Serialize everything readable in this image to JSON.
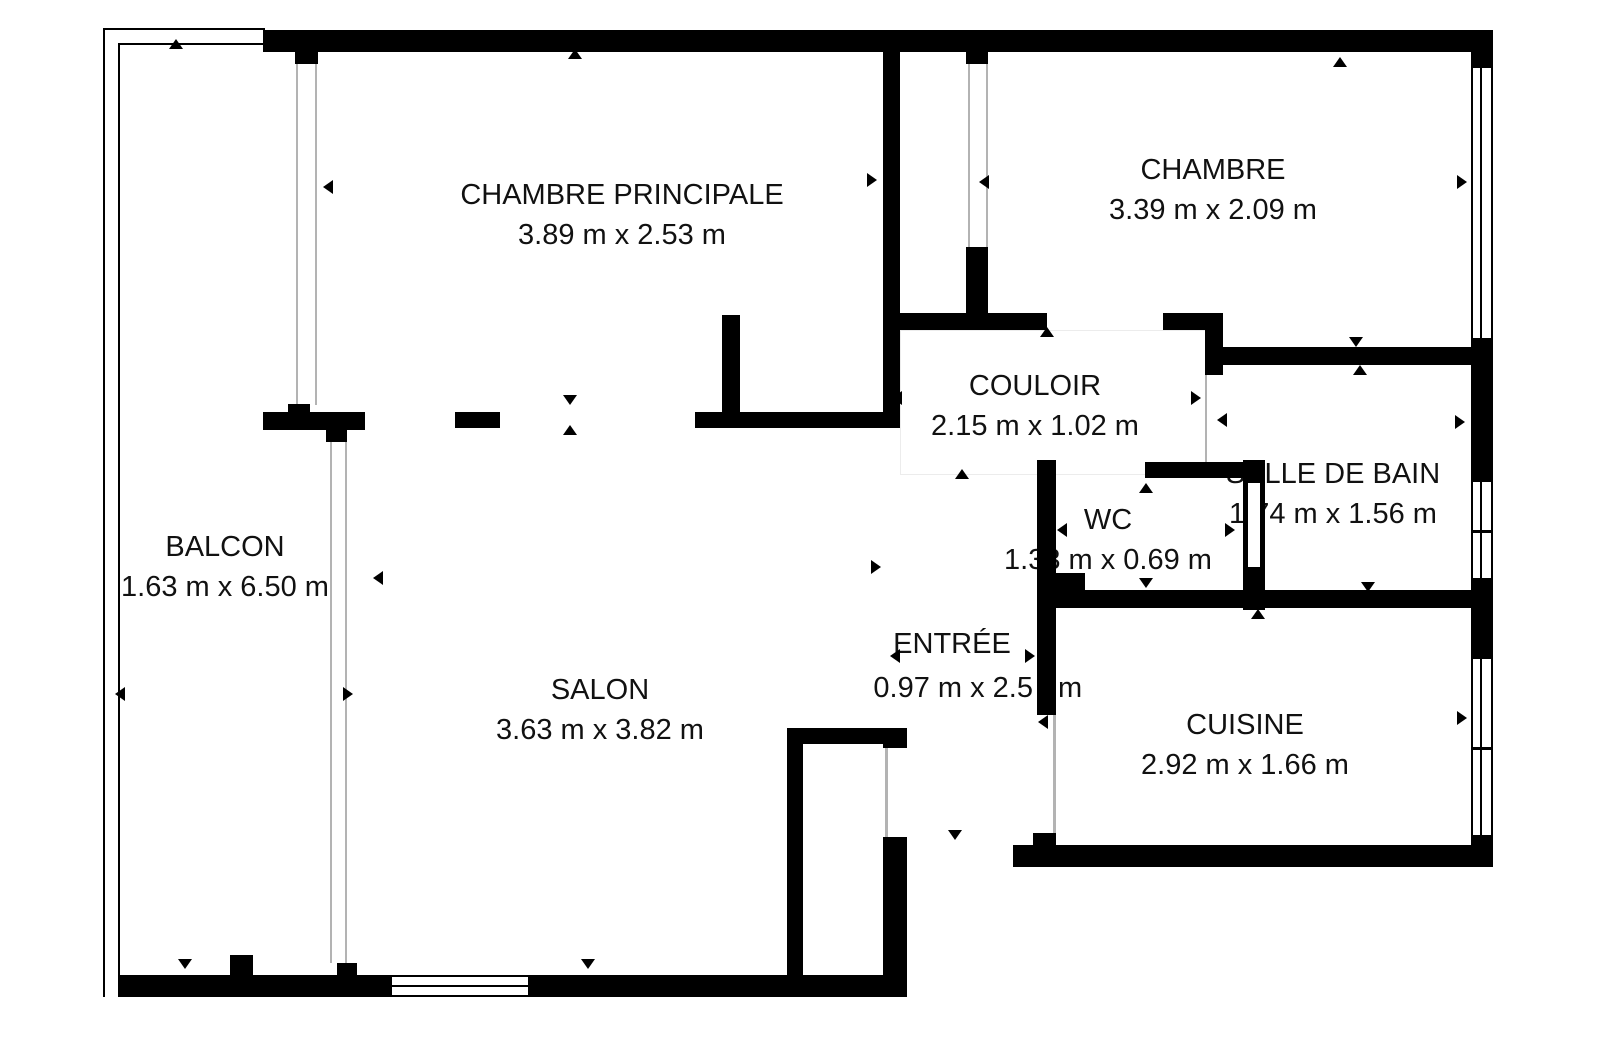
{
  "plan": {
    "type": "apartment-floor-plan",
    "units": "m",
    "colors": {
      "walls": "#000000",
      "background": "#ffffff",
      "text": "#111111"
    }
  },
  "rooms": {
    "chambre_principale": {
      "name": "CHAMBRE PRINCIPALE",
      "dims": "3.89 m x 2.53 m"
    },
    "chambre": {
      "name": "CHAMBRE",
      "dims": "3.39 m x 2.09 m"
    },
    "couloir": {
      "name": "COULOIR",
      "dims": "2.15 m x 1.02 m"
    },
    "salle_de_bain": {
      "name": "SALLE DE BAIN",
      "dims": "1.74 m x 1.56 m"
    },
    "wc": {
      "name": "WC",
      "dims": "1.33 m x 0.69 m"
    },
    "balcon": {
      "name": "BALCON",
      "dims": "1.63 m x 6.50 m"
    },
    "salon": {
      "name": "SALON",
      "dims": "3.63 m x 3.82 m"
    },
    "entree": {
      "name": "ENTRÉE",
      "dims_left": "0.97 m x 2.5",
      "dims_right": "m"
    },
    "cuisine": {
      "name": "CUISINE",
      "dims": "2.92 m x 1.66 m"
    }
  }
}
